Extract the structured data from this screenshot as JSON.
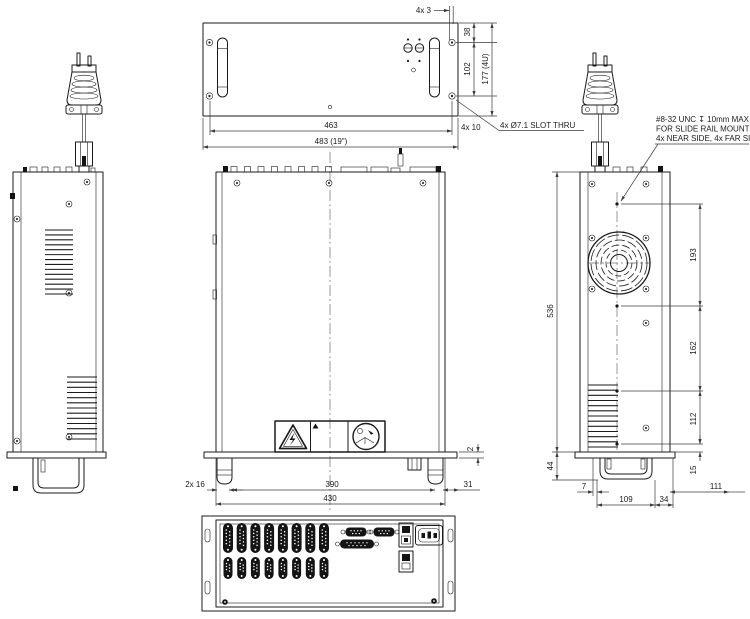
{
  "colors": {
    "background": "#ffffff",
    "line": "#1b1b1b",
    "dim": "#3c3c3c"
  },
  "front_view": {
    "dims": {
      "slot_pitch": "4x 3",
      "top_to_hole": "38",
      "hole_to_hole": "102",
      "overall_height": "177 (4U)",
      "hole_span": "463",
      "overall_width": "483 (19\")",
      "edge_offset": "4x 10",
      "slot_note": "4x Ø7.1 SLOT THRU"
    }
  },
  "top_view": {
    "dims": {
      "foot_size": "2x 16",
      "foot_span": "390",
      "overall_width": "430",
      "panel_lip": "2",
      "rear_offset": "31"
    }
  },
  "side_view": {
    "mounting_note": {
      "line1": "#8-32 UNC ↧ 10mm MAX",
      "line2": "FOR SLIDE RAIL MOUNTING",
      "line3": "4x NEAR SIDE, 4x FAR SIDE"
    },
    "dims": {
      "upper_hole_span": "193",
      "mid_hole_span": "162",
      "lower_hole_span": "112",
      "overall_depth": "536",
      "handle_height": "44",
      "hole_to_edge": "15",
      "handle_offset": "7",
      "handle_span": "109",
      "handle_to_corner": "34",
      "side_width": "111"
    }
  },
  "symbols": {
    "high_voltage_warning": "triangle-lightning-icon",
    "small_warning": "triangle-icon",
    "read_manual": "circle-read-manual-icon"
  }
}
